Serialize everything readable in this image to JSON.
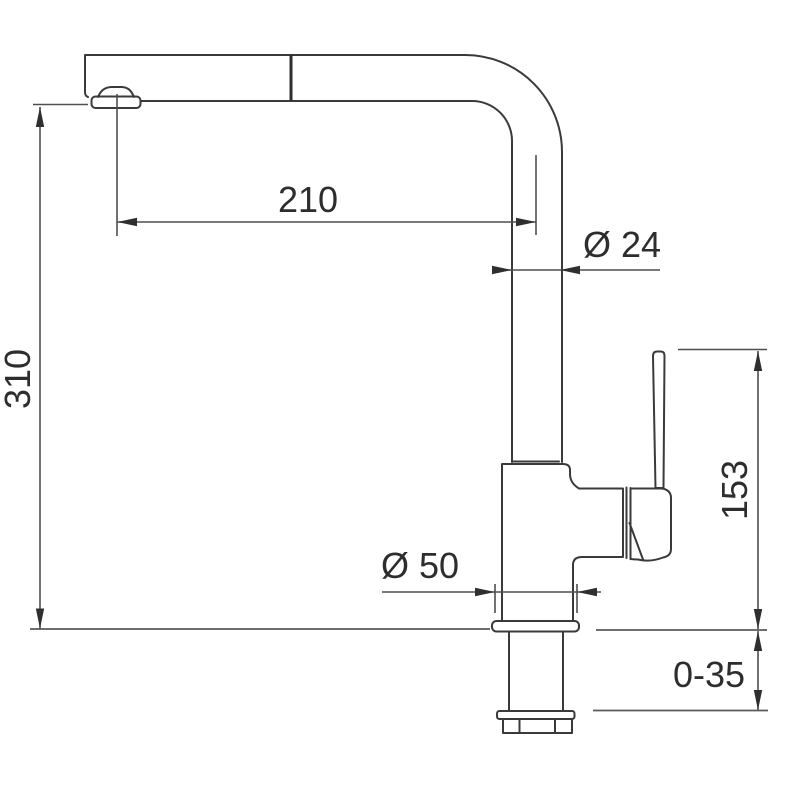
{
  "drawing": {
    "subject": "pull-out kitchen mixer tap, side elevation with installation dimensions",
    "dimensions": {
      "spout_reach": "210",
      "pipe_diameter": "Ø 24",
      "spout_height": "310",
      "handle_height": "153",
      "base_diameter": "Ø 50",
      "deck_thickness": "0-35"
    },
    "colors": {
      "background": "#ffffff",
      "outline": "#3a3a3a",
      "dimension_lines": "#4f4f4f",
      "label_text": "#2d2d2d",
      "flange_fill": "#c6c9ca"
    }
  }
}
